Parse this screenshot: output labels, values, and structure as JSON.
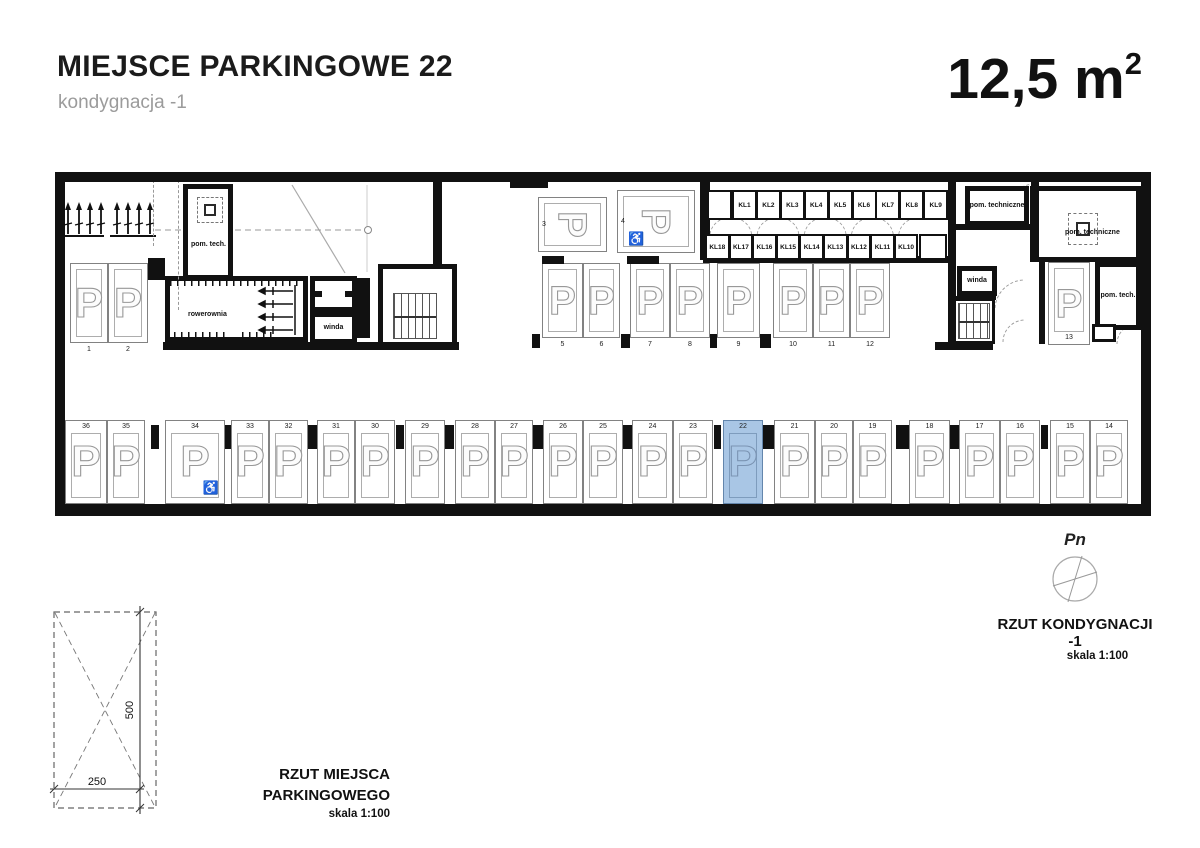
{
  "header": {
    "title": "MIEJSCE PARKINGOWE 22",
    "subtitle": "kondygnacja -1",
    "area": "12,5 m",
    "area_exp": "2"
  },
  "plan": {
    "labels": {
      "pom_tech_left": "pom. tech.",
      "rowerownia": "rowerownia",
      "winda_left": "winda",
      "winda_right": "winda",
      "pom_techniczne_top": "pom. techniczne",
      "pom_techniczne_right": "pom. techniczne",
      "pom_tech_right": "pom. tech."
    },
    "kl_top": [
      "KL1",
      "KL2",
      "KL3",
      "KL4",
      "KL5",
      "KL6",
      "KL7",
      "KL8",
      "KL9"
    ],
    "kl_bottom": [
      "KL18",
      "KL17",
      "KL16",
      "KL15",
      "KL14",
      "KL13",
      "KL12",
      "KL11",
      "KL10"
    ],
    "left_row": [
      {
        "num": "1"
      },
      {
        "num": "2"
      }
    ],
    "top_row": [
      {
        "num": "3"
      },
      {
        "num": "4",
        "handicap": true
      }
    ],
    "middle_row": [
      {
        "num": "5"
      },
      {
        "num": "6"
      },
      {
        "num": "7"
      },
      {
        "num": "8"
      },
      {
        "num": "9"
      },
      {
        "num": "10"
      },
      {
        "num": "11"
      },
      {
        "num": "12"
      }
    ],
    "side_space": {
      "num": "13"
    },
    "bottom_row": [
      {
        "num": "36"
      },
      {
        "num": "35"
      },
      {
        "num": "34",
        "handicap": true
      },
      {
        "num": "33"
      },
      {
        "num": "32"
      },
      {
        "num": "31"
      },
      {
        "num": "30"
      },
      {
        "num": "29"
      },
      {
        "num": "28"
      },
      {
        "num": "27"
      },
      {
        "num": "26"
      },
      {
        "num": "25"
      },
      {
        "num": "24"
      },
      {
        "num": "23"
      },
      {
        "num": "22",
        "highlight": true
      },
      {
        "num": "21"
      },
      {
        "num": "20"
      },
      {
        "num": "19"
      },
      {
        "num": "18"
      },
      {
        "num": "17"
      },
      {
        "num": "16"
      },
      {
        "num": "15"
      },
      {
        "num": "14"
      }
    ],
    "parking_symbol": "P",
    "handicap_symbol": "♿",
    "highlight_color": "#a9c6e5",
    "wall_color": "#111111"
  },
  "detail": {
    "caption": "RZUT MIEJSCA PARKINGOWEGO",
    "scale": "skala 1:100",
    "dim_width": "250",
    "dim_height": "500"
  },
  "compass": {
    "north_label": "Pn",
    "caption": "RZUT KONDYGNACJI -1",
    "scale": "skala 1:100"
  }
}
